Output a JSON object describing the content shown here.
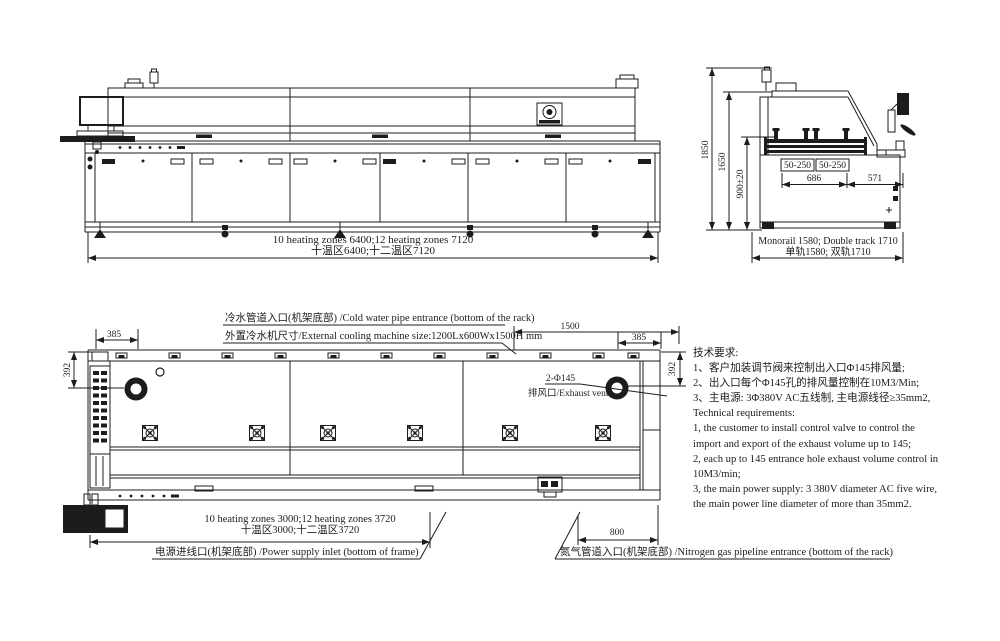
{
  "side_view": {
    "length_dim_en": "10 heating zones 6400;12 heating zones 7120",
    "length_dim_cn": "十温区6400;十二温区7120"
  },
  "end_view": {
    "height_overall": "1850",
    "height_hood": "1650",
    "rail_height": "900±20",
    "rail_width_left": "50-250",
    "rail_width_right": "50-250",
    "rail_span": "686",
    "side_offset": "571",
    "width_dim_en": "Monorail 1580; Double track 1710",
    "width_dim_cn": "单轨1580; 双轨1710"
  },
  "top_view": {
    "cold_water_note": "冷水管道入口(机架底部) /Cold water pipe entrance (bottom of the rack)",
    "cooling_size_note": "外置冷水机尺寸/External cooling machine size:1200Lx600Wx1500H mm",
    "dim_1500": "1500",
    "dim_385_left": "385",
    "dim_385_right": "385",
    "dim_392_left": "392",
    "dim_392_right": "392",
    "exhaust_callout": "2-Φ145",
    "exhaust_label": "排风口/Exhaust vent",
    "heating_dim_en": "10 heating zones 3000;12 heating zones 3720",
    "heating_dim_cn": "十温区3000;十二温区3720",
    "dim_800": "800",
    "power_note": "电源进线口(机架底部) /Power supply inlet (bottom of frame)",
    "nitrogen_note": "氮气管道入口(机架底部) /Nitrogen gas pipeline entrance (bottom of the rack)"
  },
  "tech_requirements": {
    "lines": [
      "技术要求:",
      "1、客户加装调节阀来控制出入口Φ145排风量;",
      "2、出入口每个Φ145孔的排风量控制在10M3/Min;",
      "3、主电源: 3Φ380V AC五线制, 主电源线径≥35mm2,",
      "Technical requirements:",
      "1, the customer to install control valve to control the",
      "import and export of the exhaust volume up to 145;",
      "2, each up to 145 entrance hole exhaust volume control in",
      "10M3/min;",
      "3, the main power supply: 3 380V diameter AC five wire,",
      "the main power line diameter of more than 35mm2."
    ]
  }
}
